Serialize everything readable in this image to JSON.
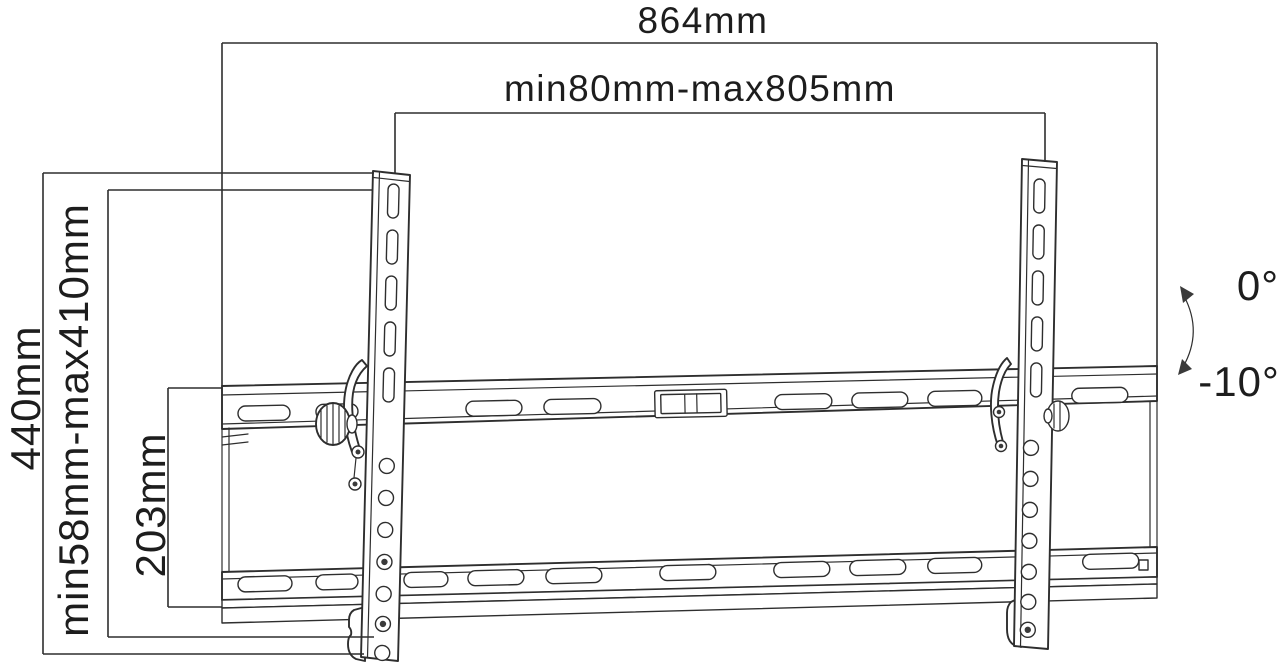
{
  "drawing": {
    "labels": {
      "overall_width": "864mm",
      "mounting_width_range": "min80mm-max805mm",
      "overall_height": "440mm",
      "mounting_height_range": "min58mm-max410mm",
      "wall_plate_height": "203mm",
      "tilt_max": "0°",
      "tilt_min": "-10°"
    },
    "colors": {
      "line": "#2e2e2e",
      "background": "#ffffff"
    }
  }
}
